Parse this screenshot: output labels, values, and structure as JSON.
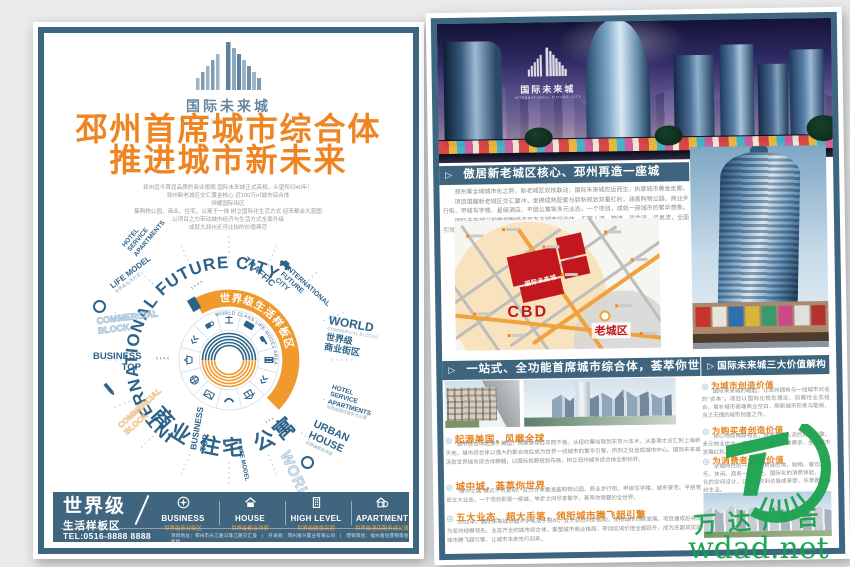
{
  "colors": {
    "frame": "#3d6680",
    "headline_orange": "#ee8422",
    "bar_blue": "#40657e",
    "accent_orange": "#f0a23c",
    "map_red": "#c0161d",
    "diagram_blue": "#2e6389",
    "watermark_green": "#1ca24f"
  },
  "logo": {
    "cn": "国际未来城",
    "en": "INTERNATIONAL FUTURE CITY"
  },
  "watermark": {
    "brand": "万达广告",
    "site": "wdad.net"
  },
  "left_page": {
    "headline1": "邳州首席城市综合体",
    "headline2": "推进城市新未来",
    "intro_lines": [
      "邳州迄今首屈品质的商业旗舰 国际未来城正式亮相，众望所归40年！",
      "邳州新老城区交汇黄金核心 近100万㎡城市综合体",
      "恒耀国际街区",
      "集购物公园、商业、住宅、公寓于一体 树立国际化生活方式 迎来都会大蓝图",
      "以项目之力带动城市经济与生活方式全面升级",
      "成就大邳州无可比拟的价值典范"
    ],
    "diagram": {
      "ring_title": "INTERNATIONAL FUTURE CITY",
      "arc_cn": "世界级生活样板区",
      "arc_en": "WORLD CLASS LIFE MODEL AREA",
      "bottom_words": "商业 住宅 公寓",
      "labels": [
        {
          "text": "HOTEL\nSERVICE\nAPARTMENTS"
        },
        {
          "text": "LIFE MODEL",
          "sub": "世界级生活方式"
        },
        {
          "text": "COMMERCIAL\nBLOCK"
        },
        {
          "text": "BUSINESS\nTOP"
        },
        {
          "text": "TRAFFIC"
        },
        {
          "text": "INTERNATIONAL\nFUTURE\nCITY"
        },
        {
          "text": "WORLD",
          "sub": "COMMERCIAL BLOCKS",
          "cn": "世界级\n商业街区"
        },
        {
          "text": "HOTEL\nSERVICE\nAPARTMENTS",
          "cn": "世界级酒店服务式公寓"
        },
        {
          "text": "URBAN\nHOUSE",
          "cn": "世界级都会洋房"
        },
        {
          "text": "WORLD"
        },
        {
          "text": "LIFE MODEL"
        },
        {
          "text": "BUSINESS\nTOP"
        },
        {
          "text": "COMMERCIAL\nBLOCK"
        }
      ]
    },
    "footer": {
      "grade_main": "世界级",
      "grade_sub": "生活样板区",
      "items": [
        {
          "en": "BUSINESS",
          "cn": "世界级商业街区"
        },
        {
          "en": "HOUSE",
          "cn": "世界级都会洋房"
        },
        {
          "en": "HIGH LEVEL",
          "cn": "世界级瞰景高层"
        },
        {
          "en": "APARTMENT",
          "cn": "世界级酒店服务式公寓"
        }
      ],
      "tel": "TEL:0516-8888 8888",
      "info": "项目地址：邳州市长江路与珠江路交汇处　|　开发商：邳州富兴置业有限公司　|　营销策划：福州富恒营销策划机构"
    }
  },
  "right_page": {
    "s1_title": "傲居新老城区核心、邳州再造一座城",
    "s1_paras": [
      "邳州乘全域城市化之势，新老城区双核联动，国际未来城应运而生，执掌城市黄金走廊。",
      "项目雄踞新老城区交汇要冲，坐拥成熟配套与崭新规划双重红利，涵盖购物公园、商业步行街、甲级写字楼、星级酒店、平层公寓等多元业态，一个项目，成就一座城市的繁华想象。",
      "国际未来城以前瞻视野缔造百万方城市综合体，汇聚人流、物流、资金流、信息流，全面引领区域价值跃升。",
      "未来已来，城市向新，国际未来城诚邀全城共鉴一座大城的崛起。"
    ],
    "map": {
      "site": "国际未来城",
      "cbd": "CBD",
      "old": "老城区"
    },
    "s2_title": "一站式、全功能首席城市综合体，荟萃你世界",
    "s2_subs": [
      {
        "h": "起源美国，风靡全球",
        "b": "城市综合体起源于美国，风靡全球百年而不衰。从纽约曼哈顿到东京六本木，从香港太古汇到上海新天地，城市综合体以强大的聚合效应成为世界一线城市的繁华引擎，所到之处皆成城市中心。国际未来城汲取世界城市综合体精髓，以国际视野规划布局，树立邳州城市综合体全新标杆。"
      },
      {
        "h": "城中城，荟萃你世界",
        "b": "“城中之城”模式不可复制，百万方体量涵盖购物公园、商业步行街、甲级写字楼、城市豪宅、平层官邸五大业态，一个项目即是一座城，举步之间尽享繁华，荟萃你想要的全世界。"
      },
      {
        "h": "五大业态、超大手笔，领衔城市腾飞超引擎",
        "b": "2011年，国际未来城以超大手笔落子邳州，五大业态同步启动，领衔城市向新发展。项目建成后将成为邳州规模领先、业态齐全的城市综合体，重塑城市商业格局，带动区域价值全面跃升，成为名副其实的城市腾飞超引擎，让城市未来先行到来。"
      }
    ],
    "s3_title": "国际未来城三大价值解构",
    "s3_subs": [
      {
        "h": "为城市创造价值",
        "b": "国际未来城的崛起，让邳州拥有与一线城市对话的“资本”。项目以国际化规划理念、前瞻性业态组合，填补城市高端商业空白，刷新城市形象与能级，当之无愧的城市封面之作。"
      },
      {
        "h": "为购买者创造价值",
        "b": "核心地段稀缺物业，自带百万人流的财富引擎。多元物业组合，满足投资与自用双重需求，坐享城市发展红利。"
      },
      {
        "h": "为消费者创造价值",
        "b": "全城向往的一站式消费目的地，购物、餐饮、娱乐、休闲、商务一应俱全。国际化的消费体验，人性化的空间设计，让每一次到访皆成享受，乐享都会缤纷生活。"
      }
    ]
  }
}
